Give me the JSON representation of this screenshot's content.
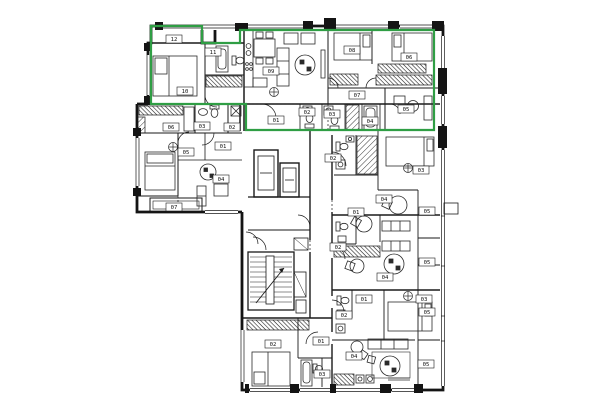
{
  "page": {
    "background": "#ffffff"
  },
  "plan": {
    "wall_color": "#1a1a1a",
    "unit_outline_color": "#2f9e44",
    "green_outline_points": "151,26 202,26 202,43 240,43 240,30 434,30 434,130 246,130 246,104 151,104",
    "room_labels": [
      {
        "text": "12",
        "x": 174,
        "y": 39
      },
      {
        "text": "10",
        "x": 185,
        "y": 91
      },
      {
        "text": "11",
        "x": 213,
        "y": 52
      },
      {
        "text": "09",
        "x": 271,
        "y": 71
      },
      {
        "text": "08",
        "x": 352,
        "y": 50
      },
      {
        "text": "06",
        "x": 409,
        "y": 57
      },
      {
        "text": "07",
        "x": 357,
        "y": 95
      },
      {
        "text": "05",
        "x": 406,
        "y": 109
      },
      {
        "text": "01",
        "x": 276,
        "y": 120
      },
      {
        "text": "02",
        "x": 307,
        "y": 112
      },
      {
        "text": "03",
        "x": 332,
        "y": 114
      },
      {
        "text": "04",
        "x": 370,
        "y": 121
      },
      {
        "text": "06",
        "x": 171,
        "y": 127
      },
      {
        "text": "03",
        "x": 202,
        "y": 126
      },
      {
        "text": "02",
        "x": 232,
        "y": 127
      },
      {
        "text": "01",
        "x": 223,
        "y": 146
      },
      {
        "text": "05",
        "x": 186,
        "y": 152
      },
      {
        "text": "04",
        "x": 221,
        "y": 179
      },
      {
        "text": "07",
        "x": 174,
        "y": 207
      },
      {
        "text": "02",
        "x": 333,
        "y": 158
      },
      {
        "text": "03",
        "x": 421,
        "y": 170
      },
      {
        "text": "04",
        "x": 384,
        "y": 199
      },
      {
        "text": "01",
        "x": 356,
        "y": 212
      },
      {
        "text": "05",
        "x": 427,
        "y": 211
      },
      {
        "text": "02",
        "x": 338,
        "y": 247
      },
      {
        "text": "04",
        "x": 385,
        "y": 277
      },
      {
        "text": "05",
        "x": 427,
        "y": 262
      },
      {
        "text": "01",
        "x": 364,
        "y": 299
      },
      {
        "text": "03",
        "x": 424,
        "y": 299
      },
      {
        "text": "05",
        "x": 427,
        "y": 312
      },
      {
        "text": "02",
        "x": 344,
        "y": 315
      },
      {
        "text": "02",
        "x": 273,
        "y": 344
      },
      {
        "text": "01",
        "x": 321,
        "y": 341
      },
      {
        "text": "03",
        "x": 322,
        "y": 374
      },
      {
        "text": "04",
        "x": 354,
        "y": 356
      },
      {
        "text": "05",
        "x": 426,
        "y": 364
      }
    ]
  }
}
